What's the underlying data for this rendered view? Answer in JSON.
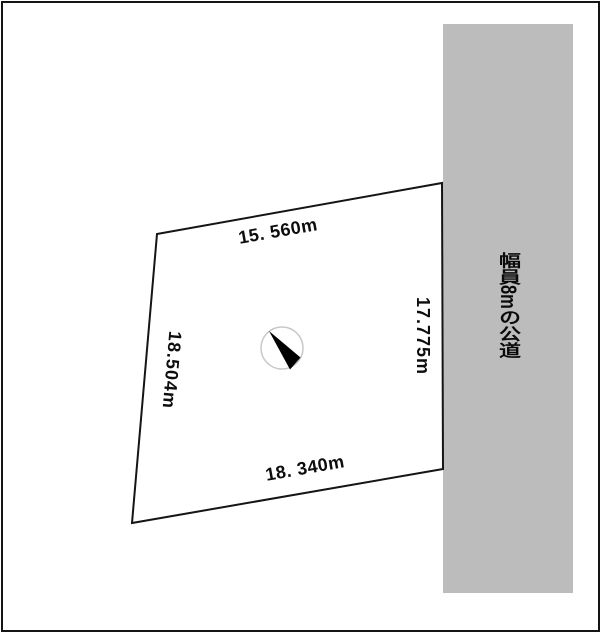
{
  "diagram": {
    "parcel_dimensions": {
      "top": "15. 560m",
      "bottom": "18. 340m",
      "left": "18.504m",
      "right": "17.775m"
    },
    "road_label": "幅員8mの公道",
    "icons": {
      "north_arrow": "north-arrow-icon"
    },
    "colors": {
      "background": "#ffffff",
      "frame": "#141414",
      "road_band": "#bcbcbc",
      "parcel_outline": "#151515",
      "north_circle": "#c8c8c8",
      "north_needle": "#000000",
      "text": "#0d0d0d"
    }
  }
}
